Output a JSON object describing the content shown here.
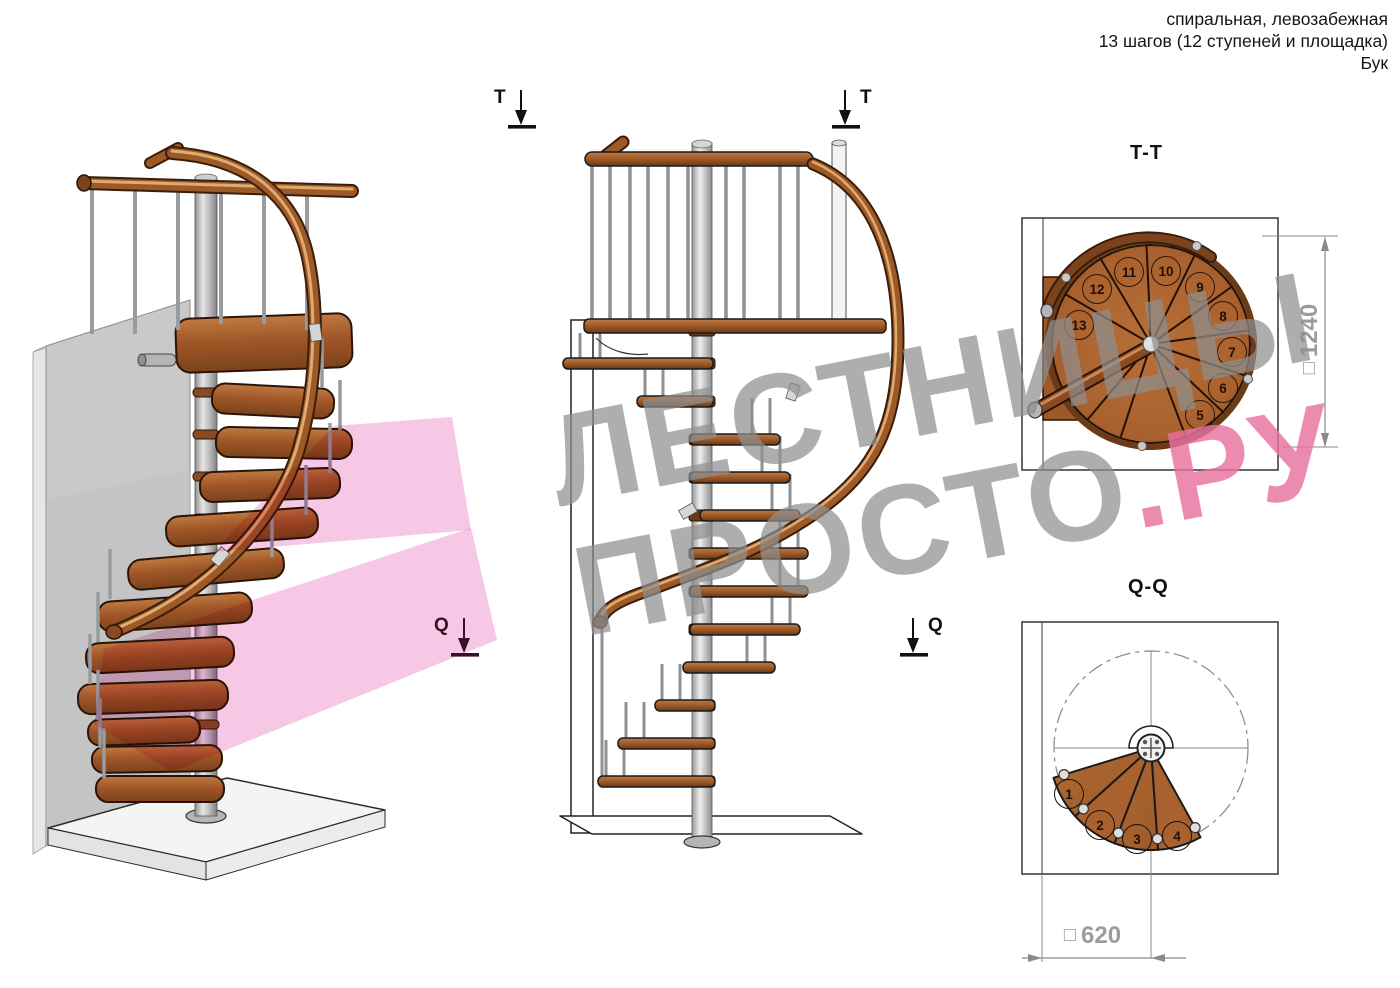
{
  "header": {
    "line1": "спиральная, левозабежная",
    "line2": "13 шагов (12 ступеней и площадка)",
    "line3": "Бук"
  },
  "watermark": {
    "line1": "ЛЕСТНИЦЫ",
    "line2_main": "ПРОСТО",
    "line2_accent": ".РУ"
  },
  "sections": {
    "t_left": "T",
    "t_right": "T",
    "q_iso": "Q",
    "q_right": "Q"
  },
  "tt_view": {
    "label": "T-T",
    "dim_square": "□",
    "dim_value": "1240",
    "step_numbers": [
      5,
      6,
      7,
      8,
      9,
      10,
      11,
      12,
      13
    ]
  },
  "qq_view": {
    "label": "Q-Q",
    "dim_square": "□",
    "dim_value": "620",
    "step_numbers": [
      1,
      2,
      3,
      4
    ]
  },
  "colors": {
    "wood": "#a9612f",
    "wood_dark": "#6b3a16",
    "metal_pole": "#b9b9b9",
    "wall_gray": "#c9c9c9",
    "pink_overlay": "#f092cc",
    "watermark_gray": "#8f8f8f",
    "watermark_accent": "#e8729f",
    "dim_text": "#9c9c9c",
    "line": "#1a1a1a"
  }
}
